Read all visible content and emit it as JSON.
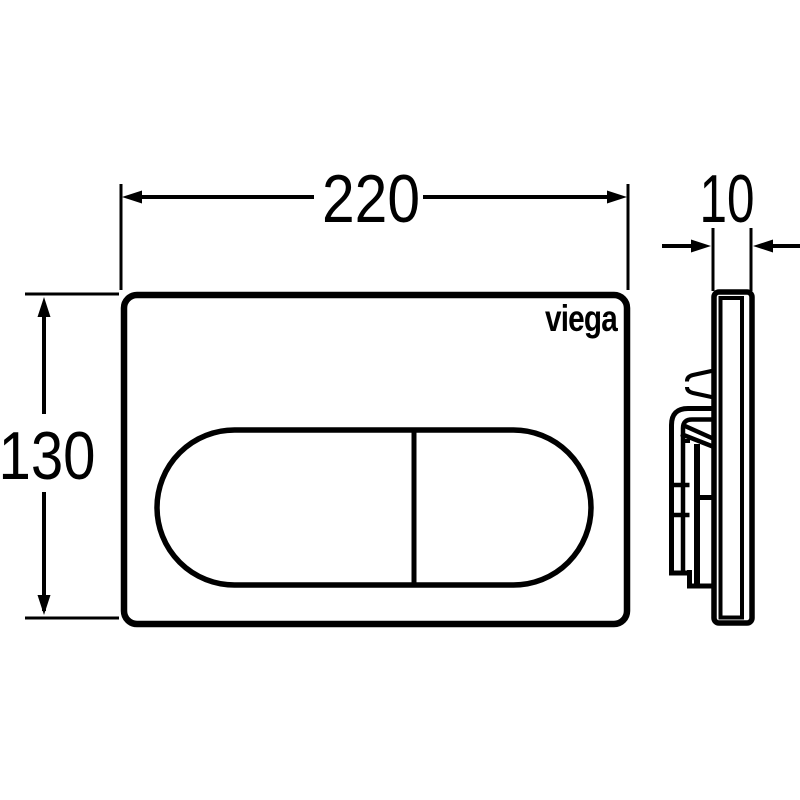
{
  "drawing": {
    "brand": "viega",
    "colors": {
      "line": "#000000",
      "background": "#ffffff"
    },
    "dimensions": {
      "width": "220",
      "height": "130",
      "depth": "10"
    }
  }
}
